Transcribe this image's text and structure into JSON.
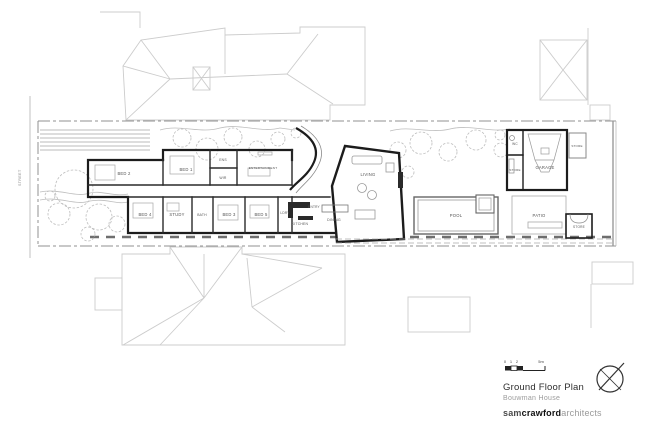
{
  "title_block": {
    "title": "Ground Floor Plan",
    "subtitle": "Bouwman House",
    "firm_part1": "sam",
    "firm_part2": "crawford",
    "firm_part3": "architects",
    "scale_ticks": [
      "0",
      "1",
      "2"
    ],
    "scale_end": "5m"
  },
  "street": {
    "label": "STREET"
  },
  "colors": {
    "wall": "#1c1c1c",
    "neighbor_line": "#cccccc",
    "garden_line": "#bdbdbd",
    "boundary": "#909090",
    "furniture": "#9a9a9a",
    "label": "#555555"
  },
  "plan": {
    "rooms": [
      {
        "label": "BED 2",
        "x": 124,
        "y": 175
      },
      {
        "label": "BED 1",
        "x": 186,
        "y": 171
      },
      {
        "label": "ENS",
        "x": 223,
        "y": 161,
        "size": 3.4
      },
      {
        "label": "WIR",
        "x": 223,
        "y": 179,
        "size": 3.4
      },
      {
        "label": "ENTERTAINMENT",
        "x": 263,
        "y": 169,
        "size": 3.1
      },
      {
        "label": "BED 4",
        "x": 145,
        "y": 216
      },
      {
        "label": "STUDY",
        "x": 177,
        "y": 216
      },
      {
        "label": "BATH",
        "x": 202,
        "y": 216,
        "size": 3.4
      },
      {
        "label": "BED 3",
        "x": 229,
        "y": 216
      },
      {
        "label": "BED 5",
        "x": 261,
        "y": 216
      },
      {
        "label": "LDRY",
        "x": 285,
        "y": 214,
        "size": 3.2
      },
      {
        "label": "KITCHEN",
        "x": 300,
        "y": 225,
        "size": 3.4
      },
      {
        "label": "ENTRY",
        "x": 314,
        "y": 208,
        "size": 3.2
      },
      {
        "label": "DINING",
        "x": 334,
        "y": 221,
        "size": 3.6
      },
      {
        "label": "LIVING",
        "x": 368,
        "y": 176
      },
      {
        "label": "POOL",
        "x": 456,
        "y": 217
      },
      {
        "label": "PATIO",
        "x": 539,
        "y": 217
      },
      {
        "label": "GARAGE",
        "x": 545,
        "y": 169
      },
      {
        "label": "WC",
        "x": 515,
        "y": 145,
        "size": 3.2
      },
      {
        "label": "STORE",
        "x": 515,
        "y": 171,
        "size": 3.0
      },
      {
        "label": "STORE",
        "x": 577,
        "y": 147,
        "size": 3.0
      },
      {
        "label": "STORE",
        "x": 579,
        "y": 228,
        "size": 3.2
      }
    ]
  }
}
